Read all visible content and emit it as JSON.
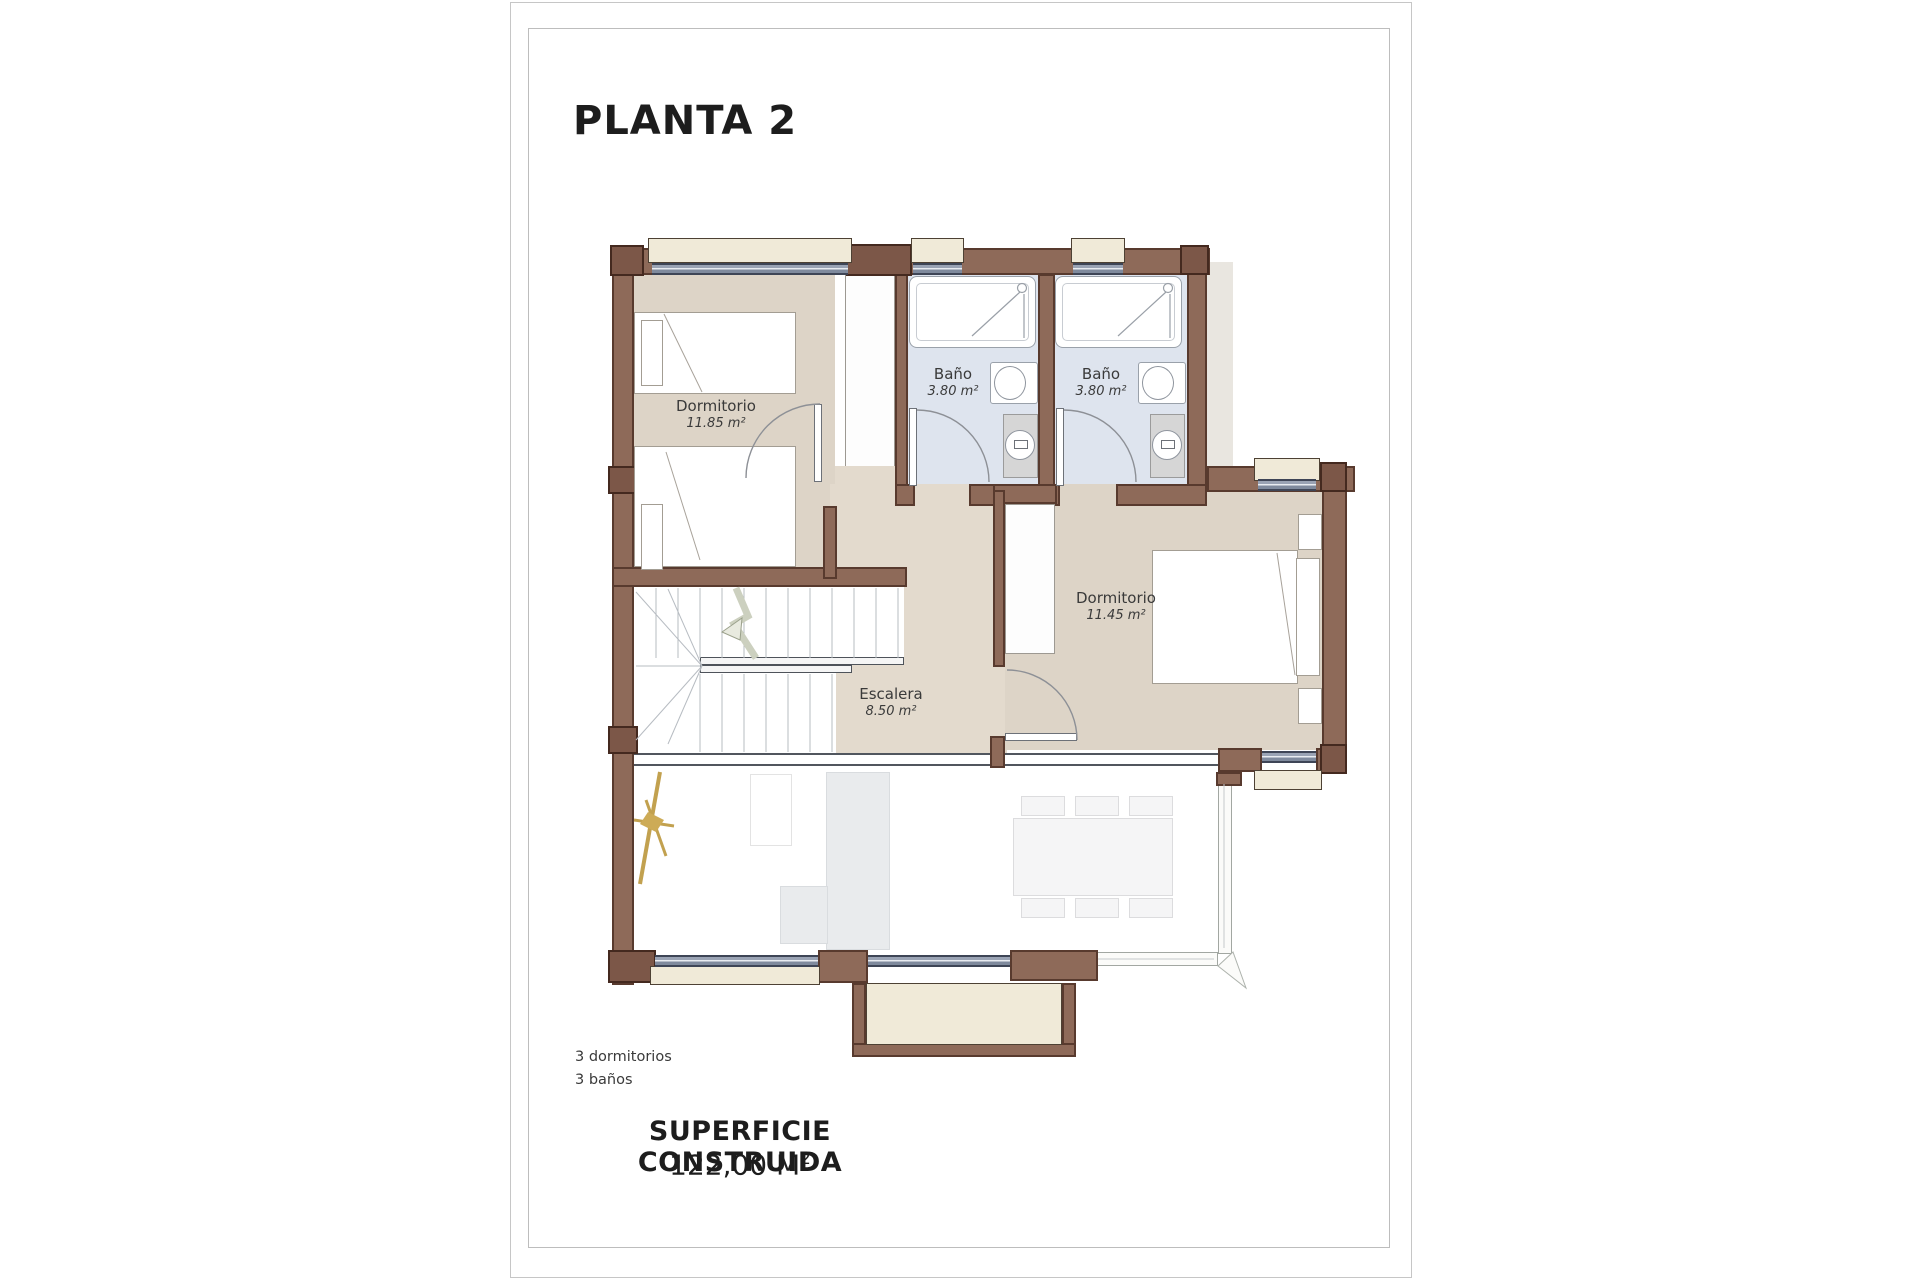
{
  "page": {
    "title": "PLANTA 2",
    "features": [
      "3 dormitorios",
      "3 baños"
    ],
    "summary": {
      "label": "SUPERFICIE CONSTRUIDA",
      "value": "122,00 M",
      "sup": "2"
    }
  },
  "rooms": [
    {
      "id": "dormitorio-1",
      "name": "Dormitorio",
      "area": "11.85 m²"
    },
    {
      "id": "bano-1",
      "name": "Baño",
      "area": "3.80 m²"
    },
    {
      "id": "bano-2",
      "name": "Baño",
      "area": "3.80 m²"
    },
    {
      "id": "dormitorio-2",
      "name": "Dormitorio",
      "area": "11.45 m²"
    },
    {
      "id": "escalera",
      "name": "Escalera",
      "area": "8.50 m²"
    }
  ],
  "colors": {
    "wall": "#8e6a59",
    "wallDark": "#583a2e",
    "pier": "#7c5748",
    "pierDark": "#44291f",
    "floor": "#ddd4c7",
    "hall": "#e3dacd",
    "bath": "#dee4ee",
    "sill": "#f0ead8",
    "sillDark": "#4d4134",
    "shadow": "#e9e6e0",
    "window": "#8c95a8",
    "plant": "#c2a14f",
    "ink": "#1d1d1d",
    "label": "#3a3a3a"
  }
}
